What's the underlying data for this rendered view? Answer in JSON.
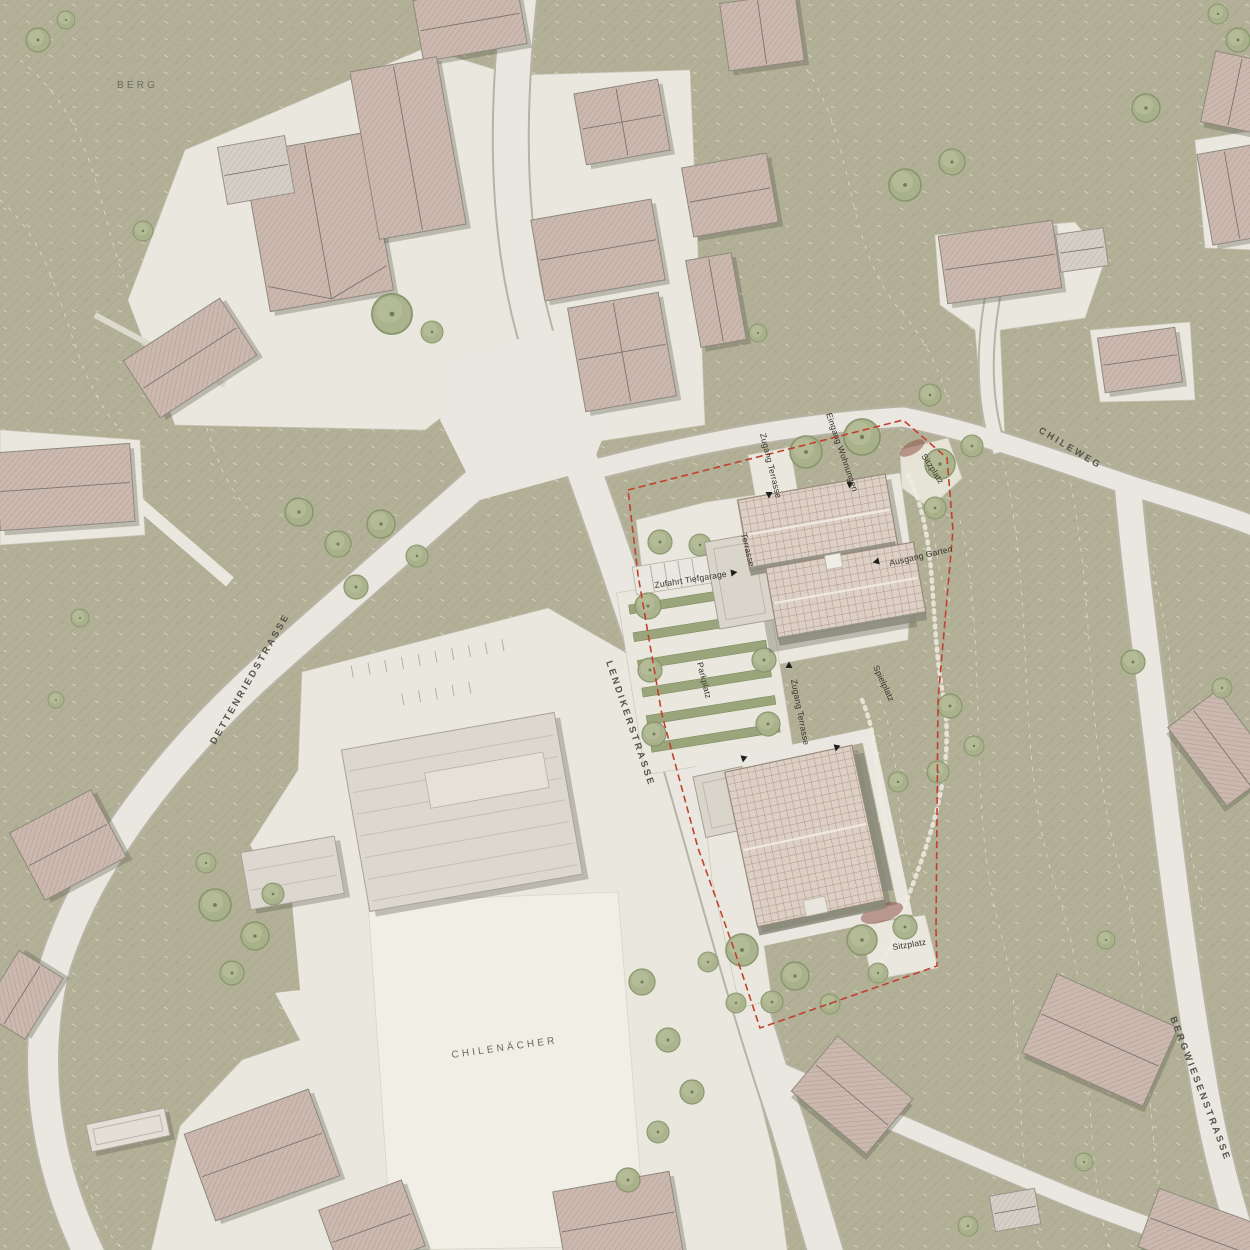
{
  "map": {
    "area_labels": {
      "berg": "BERG",
      "chilenaecher": "CHILENÄCHER"
    },
    "streets": {
      "dettenriedstrasse": "DETTENRIEDSTRASSE",
      "lendikerstrasse": "LENDIKERSTRASSE",
      "chileweg": "CHILEWEG",
      "bergwiesenstrasse": "BERGWIESENSTRASSE"
    },
    "site": {
      "zufahrt_tiefgarage": "Zufahrt Tiefgarage",
      "parkplatz": "Parkplatz",
      "terrasse": "Terrasse",
      "zugang_terrasse_north": "Zugang Terrasse",
      "zugang_terrasse_south": "Zugang Terrasse",
      "eingang_wohnungen": "Eingang Wohnungen",
      "ausgang_garten": "Ausgang Garten",
      "sitzplatz_north": "Sitzplatz",
      "sitzplatz_south": "Sitzplatz",
      "spielplatz": "Spielplatz"
    },
    "colors": {
      "grass": "#b2b097",
      "road": "#e9e7df",
      "paved": "#eae8de",
      "field": "#f0eee5",
      "roof_existing": "#cbb8af",
      "roof_existing_light": "#d5cfc7",
      "roof_new": "#dccfc5",
      "roof_new_line": "#aa8a79",
      "tree": "#a9b28b",
      "shrub_red": "#91564b",
      "site_boundary": "#c2402f",
      "text": "#42413a"
    }
  }
}
